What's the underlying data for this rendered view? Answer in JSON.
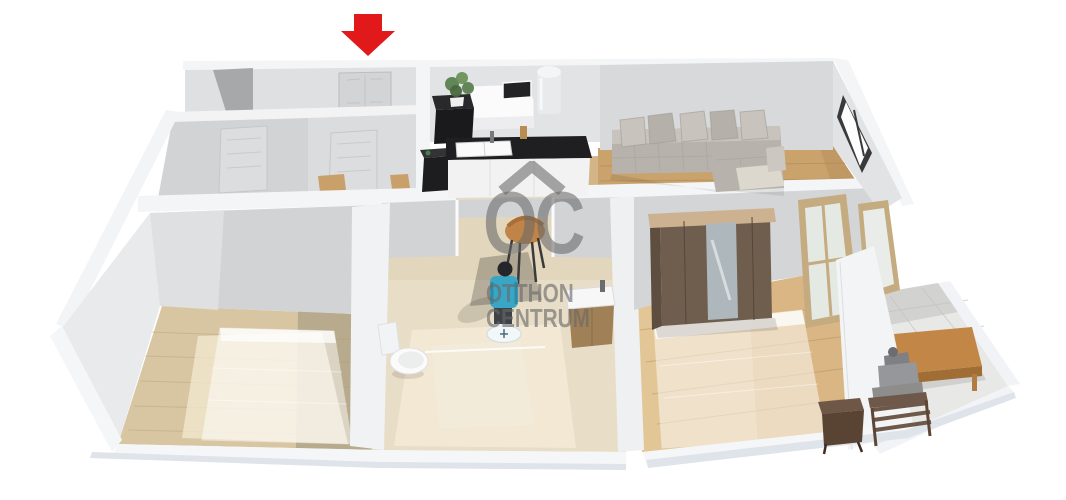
{
  "meta": {
    "title": "3D apartment floor plan rendering",
    "brand": "Otthon Centrum"
  },
  "watermark": {
    "logo_letters": "OC",
    "line1": "OTTHON",
    "line2": "CENTRUM"
  },
  "annotation": {
    "arrow_direction": "down",
    "arrow_target": "entrance-door"
  },
  "colors": {
    "arrow-red": "#e2191b",
    "logo-gray": "#696969",
    "wall-white": "#f4f5f6",
    "wall-light": "#e2e3e5",
    "wall-gray": "#d2d3d5",
    "wall-dark": "#a7a8aa",
    "floor-wood": "#c9a26c",
    "floor-wood-light": "#d8c5a2",
    "floor-wood-pale": "#e7d0a2",
    "floor-tile": "#e8ddc7",
    "tile-light": "#f3ead6",
    "balcony-tile": "#e8e8e6",
    "counter-black": "#1f1f21",
    "cabinet-black": "#1d1d1f",
    "sofa-gray": "#b7b3ac",
    "sofa-light": "#c8c4bd",
    "cushion-cream": "#ddd8ce",
    "wardrobe-brown": "#6f5e4e",
    "wood-trim": "#cdb291",
    "mirror-gray": "#aeb8bc",
    "table-wood": "#c28646",
    "night-brown": "#594434",
    "door-frame-tan": "#c5ab80",
    "person-shirt": "#3aa6c6",
    "person-pants": "#3f4348",
    "plant-green": "#5c8150",
    "base-shadow": "#dfe3ea"
  },
  "scene": {
    "rooms": [
      {
        "name": "entry-hall",
        "floor": "tile-beige"
      },
      {
        "name": "kitchen",
        "floor": "tile-beige"
      },
      {
        "name": "living-room",
        "floor": "wood"
      },
      {
        "name": "bedroom-left",
        "floor": "wood"
      },
      {
        "name": "bathroom",
        "floor": "tile-beige"
      },
      {
        "name": "bedroom-right",
        "floor": "wood"
      },
      {
        "name": "balcony",
        "floor": "tile-gray"
      }
    ],
    "furniture": [
      "entrance-door",
      "interior-door-a",
      "interior-door-b",
      "corner-sofa",
      "throw-pillows",
      "kitchen-counter",
      "kitchen-sink",
      "fridge-cabinet",
      "water-heater",
      "plant",
      "side-table",
      "trash-cabinet",
      "wall-picture",
      "window",
      "toilet",
      "sink-vanity",
      "bistro-chair",
      "standing-person",
      "location-disc",
      "wardrobe-with-mirror",
      "ghost-bed-left",
      "ghost-bed-right",
      "nightstand",
      "balcony-door",
      "coffee-table",
      "outdoor-chair",
      "seated-person"
    ]
  }
}
